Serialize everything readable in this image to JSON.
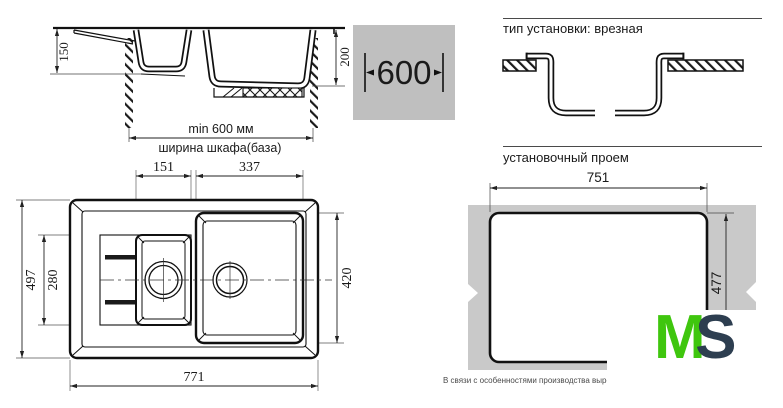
{
  "side_view": {
    "dim_bowl1_depth": "150",
    "dim_bowl2_depth": "200",
    "min_width_label": "min 600 мм",
    "cabinet_width_label": "ширина шкафа(база)"
  },
  "cabinet_badge": {
    "width_value": "600"
  },
  "install_type_section": {
    "heading": "тип установки: врезная"
  },
  "opening_section": {
    "heading": "установочный проем",
    "dim_width": "751",
    "dim_height": "477",
    "production_note": "В связи с особенностями производства вырез в с"
  },
  "plan_view": {
    "dim_bowl1_width": "151",
    "dim_bowl2_width": "337",
    "dim_overall_depth": "497",
    "dim_bowl1_zone_depth": "280",
    "dim_bowl2_depth": "420",
    "dim_overall_width": "771"
  },
  "logo": {
    "letter_m": "M",
    "letter_s": "S"
  },
  "colors": {
    "line": "#1a1a1a",
    "countertop_gray": "#c9c9c9",
    "badge_gray": "#bfbfbf",
    "logo_green": "#3fc60e",
    "logo_dark": "#2d3e50"
  }
}
